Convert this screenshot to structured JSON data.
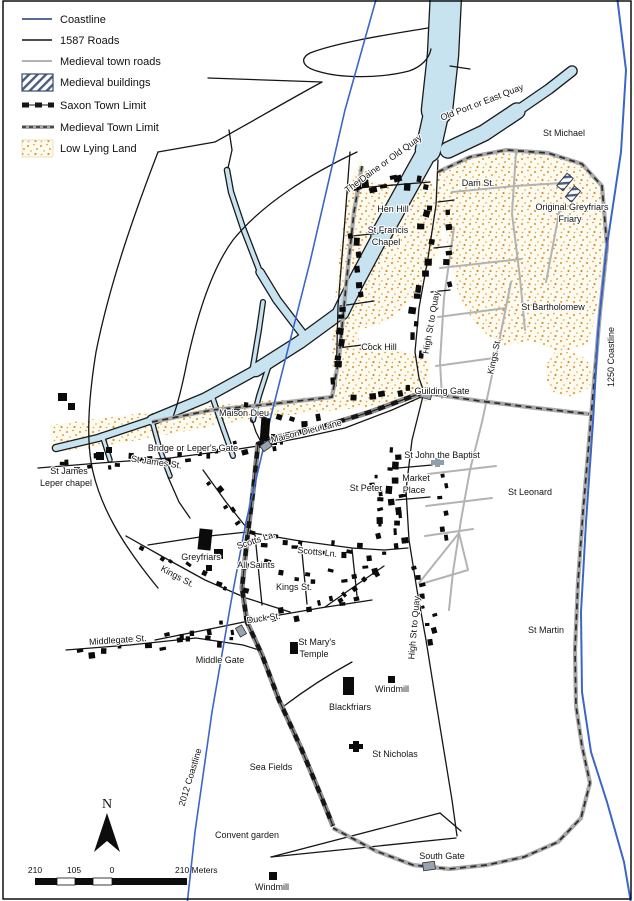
{
  "legend": {
    "items": [
      {
        "label": "Coastline"
      },
      {
        "label": "1587 Roads"
      },
      {
        "label": "Medieval town roads"
      },
      {
        "label": "Medieval buildings"
      },
      {
        "label": "Saxon Town Limit"
      },
      {
        "label": "Medieval Town Limit"
      },
      {
        "label": "Low Lying Land"
      }
    ]
  },
  "map": {
    "labels": {
      "old_port": "Old Port or East Quay",
      "daine": "The Daine or Old Quay",
      "st_michael": "St Michael",
      "dam_st": "Dam St.",
      "friary1": "Original Greyfriars",
      "friary2": "Friary",
      "hen_hill": "Hen Hill",
      "francis1": "St Francis",
      "francis2": "Chapel",
      "st_bartholomew": "St Bartholomew",
      "cock_hill": "Cock Hill",
      "kings_upper": "Kings St.",
      "high_upper": "High St to Quay",
      "c1250": "1250 Coastline",
      "guilding": "Guilding Gate",
      "maison": "Maison Dieu",
      "maison_lane": "Maison Dieu Lane",
      "bridge": "Bridge or Leper's Gate",
      "james_st": "St James St.",
      "james1": "St James",
      "james2": "Leper chapel",
      "st_john": "St John the Baptist",
      "market1": "Market",
      "market2": "Place",
      "st_peter": "St Peter",
      "st_leonard": "St Leonard",
      "scotts_la": "Scotts La.",
      "scotts_ln": "Scotts Ln.",
      "greyfriars": "Greyfriars",
      "all_saints": "All Saints",
      "kings_diag": "Kings St.",
      "kings_small": "Kings St.",
      "duck": "Duck St.",
      "high_lower": "High St to Quay",
      "st_martin": "St Martin",
      "middlegate": "Middlegate St.",
      "middle_gate": "Middle Gate",
      "marys1": "St Mary's",
      "marys2": "Temple",
      "windmill1": "Windmill",
      "blackfriars": "Blackfriars",
      "st_nicholas": "St Nicholas",
      "sea_fields": "Sea Fields",
      "c2012": "2012 Coastline",
      "convent": "Convent garden",
      "south_gate": "South Gate",
      "windmill2": "Windmill"
    }
  },
  "scale_bar": {
    "t210l": "210",
    "t105": "105",
    "t0": "0",
    "tend": "210 Meters"
  },
  "compass": {
    "n": "N"
  },
  "colors": {
    "water": "#C7E3F0",
    "coastline_blue": "#3B66C8",
    "stipple_dot": "#E2A23B",
    "building": "#0b0b0b",
    "medieval_road": "#b3b3b3",
    "legend_coastline": "#1f3a7a"
  }
}
